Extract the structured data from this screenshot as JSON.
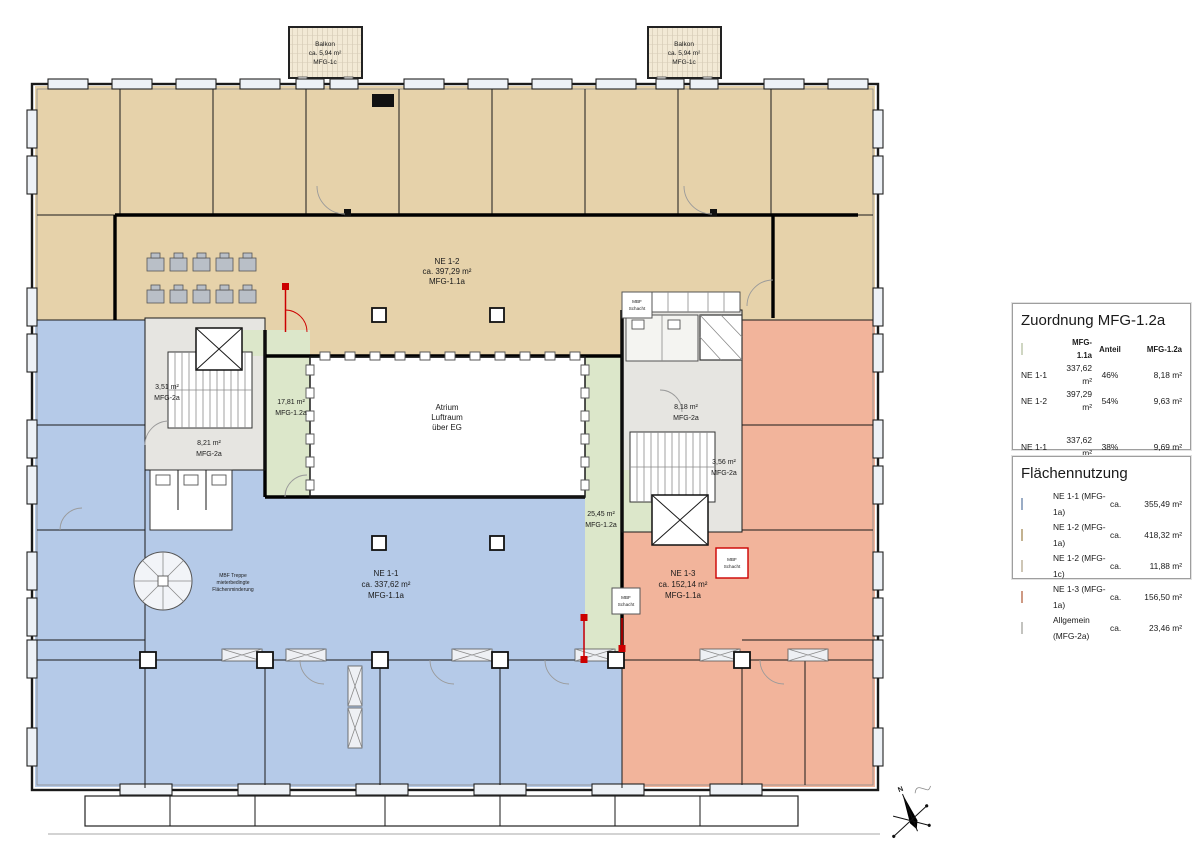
{
  "colors": {
    "ne11": "#b5cae8",
    "ne12": "#e6d2aa",
    "ne12c": "#f2e9d5",
    "ne13": "#f2b49b",
    "allgemein": "#e6e5e1",
    "mfg12a": "#dce7ca",
    "accent_red": "#cc0000"
  },
  "plan": {
    "balkon_nw": [
      "Balkon",
      "ca. 5,94 m²",
      "MFG-1c"
    ],
    "balkon_ne": [
      "Balkon",
      "ca. 5,94 m²",
      "MFG-1c"
    ],
    "ne12_label": [
      "NE 1-2",
      "ca. 397,29 m²",
      "MFG-1.1a"
    ],
    "ne11_label": [
      "NE 1-1",
      "ca. 337,62 m²",
      "MFG-1.1a"
    ],
    "ne13_label": [
      "NE 1-3",
      "ca. 152,14 m²",
      "MFG-1.1a"
    ],
    "atrium_label": [
      "Atrium",
      "Luftraum",
      "über EG"
    ],
    "room_351": [
      "3,51 m²",
      "MFG-2a"
    ],
    "room_821": [
      "8,21 m²",
      "MFG-2a"
    ],
    "room_1781": [
      "17,81 m²",
      "MFG-1.2a"
    ],
    "room_818": [
      "8,18 m²",
      "MFG-2a"
    ],
    "room_356": [
      "3,56 m²",
      "MFG-2a"
    ],
    "room_2545": [
      "25,45 m²",
      "MFG-1.2a"
    ],
    "spiral_note": [
      "MBF Treppe",
      "mieterbedingte",
      "Flächenminderung"
    ],
    "shaft_label": [
      "MBF",
      "Schacht"
    ],
    "compass_north": "N"
  },
  "legend_assignment": {
    "title": "Zuordnung MFG-1.2a",
    "headers": [
      "MFG-1.1a",
      "Anteil",
      "MFG-1.2a"
    ],
    "group1": [
      {
        "name": "NE 1-1",
        "area": "337,62 m²",
        "share": "46%",
        "target": "8,18 m²"
      },
      {
        "name": "NE 1-2",
        "area": "397,29 m²",
        "share": "54%",
        "target": "9,63 m²"
      }
    ],
    "group2": [
      {
        "name": "NE 1-1",
        "area": "337,62 m²",
        "share": "38%",
        "target": "9,69 m²"
      },
      {
        "name": "NE 1-2",
        "area": "397,29 m²",
        "share": "45%",
        "target": "11,40 m²"
      },
      {
        "name": "NE 1-3",
        "area": "152,14 m²",
        "share": "17%",
        "target": "4,36 m²"
      }
    ]
  },
  "legend_usage": {
    "title": "Flächennutzung",
    "approx": "ca.",
    "items": [
      {
        "label": "NE 1-1 (MFG-1a)",
        "value": "355,49 m²",
        "swatch": "ne11"
      },
      {
        "label": "NE 1-2 (MFG-1a)",
        "value": "418,32 m²",
        "swatch": "ne12"
      },
      {
        "label": "NE 1-2 (MFG-1c)",
        "value": "11,88 m²",
        "swatch": "ne12c"
      },
      {
        "label": "NE 1-3 (MFG-1a)",
        "value": "156,50 m²",
        "swatch": "ne13"
      },
      {
        "label": "Allgemein (MFG-2a)",
        "value": "23,46 m²",
        "swatch": "allgemein"
      }
    ]
  }
}
